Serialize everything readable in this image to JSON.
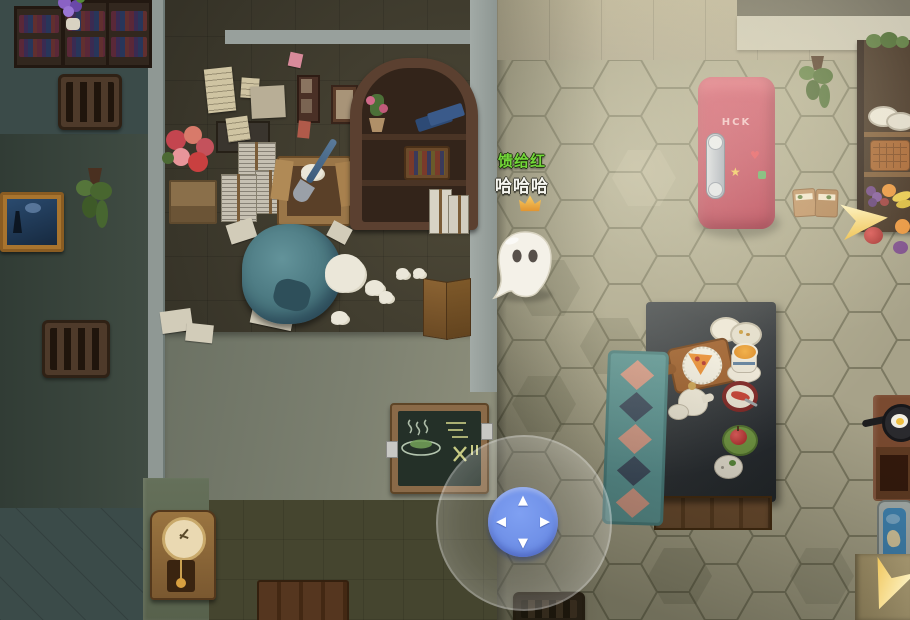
{
  "game": {
    "player": {
      "name": "馈给红",
      "name_color": "#72d838",
      "chat_message": "哈哈哈",
      "host_crown": true,
      "character": "white-ghost"
    },
    "joystick": {
      "up": "▲",
      "right": "▶",
      "down": "▼",
      "left": "◀",
      "pad_color": "#6e8fe6",
      "ring_color": "rgba(255,255,255,0.25)"
    },
    "fridge_brand": "HCK",
    "fridge_color": "#c23a52",
    "objective_arrow_color": "#f3cf6e",
    "icons": {
      "crown-icon": "gold host crown above player",
      "ghost-icon": "white ghost player character with two dark eyes",
      "direction-arrow-icon": "yellow objective pointer arrow",
      "dpad-up-icon": "▲",
      "dpad-right-icon": "▶",
      "dpad-down-icon": "▼",
      "dpad-left-icon": "◀"
    }
  }
}
